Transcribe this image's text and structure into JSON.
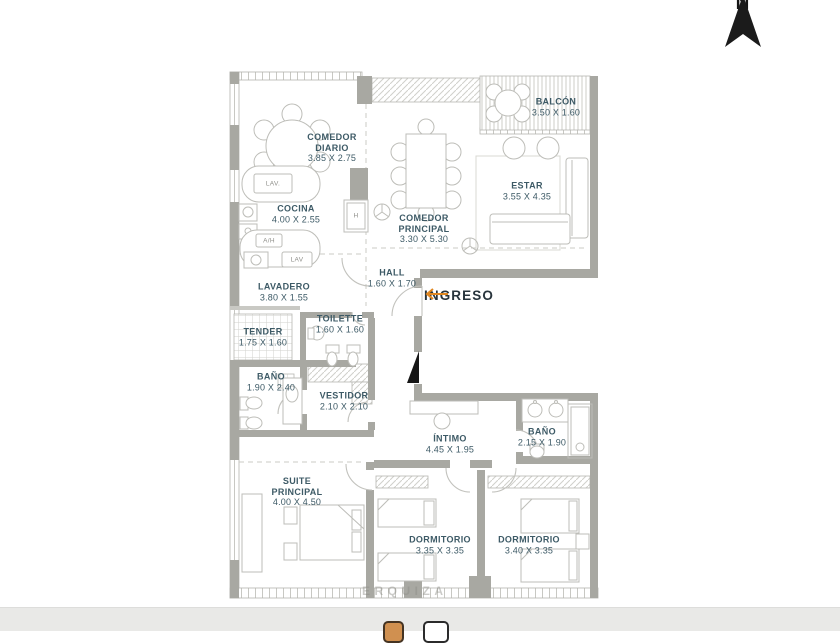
{
  "page": {
    "background": "#ffffff",
    "footer_band_color": "#e9e9e7"
  },
  "colors": {
    "wall": "#a8a8a2",
    "line": "#bdbdb8",
    "label": "#3d5a66",
    "entry_arrow": "#e0861f",
    "entry_text": "#28343c"
  },
  "compass": {
    "label": "N"
  },
  "entry": {
    "label": "INGRESO"
  },
  "watermark": {
    "text": "ERQUIZA"
  },
  "rooms": [
    {
      "id": "comedor-diario",
      "name": "COMEDOR DIARIO",
      "dims": "3.85 X 2.75"
    },
    {
      "id": "cocina",
      "name": "COCINA",
      "dims": "4.00 X 2.55"
    },
    {
      "id": "lavadero",
      "name": "LAVADERO",
      "dims": "3.80 X 1.55"
    },
    {
      "id": "tender",
      "name": "TENDER",
      "dims": "1.75 X 1.60"
    },
    {
      "id": "comedor-principal",
      "name": "COMEDOR PRINCIPAL",
      "dims": "3.30 X 5.30"
    },
    {
      "id": "estar",
      "name": "ESTAR",
      "dims": "3.55 X 4.35"
    },
    {
      "id": "balcon",
      "name": "BALCÓN",
      "dims": "3.50 X 1.60"
    },
    {
      "id": "hall",
      "name": "HALL",
      "dims": "1.60 X 1.70"
    },
    {
      "id": "toilette",
      "name": "TOILETTE",
      "dims": "1.60 X 1.60"
    },
    {
      "id": "bano-principal",
      "name": "BAÑO",
      "dims": "1.90 X 2.40"
    },
    {
      "id": "vestidor",
      "name": "VESTIDOR",
      "dims": "2.10 X 2.10"
    },
    {
      "id": "intimo",
      "name": "ÍNTIMO",
      "dims": "4.45 X 1.95"
    },
    {
      "id": "bano-2",
      "name": "BAÑO",
      "dims": "2.15 X 1.90"
    },
    {
      "id": "suite-principal",
      "name": "SUITE PRINCIPAL",
      "dims": "4.00 X 4.50"
    },
    {
      "id": "dormitorio-1",
      "name": "DORMITORIO",
      "dims": "3.35 X 3.35"
    },
    {
      "id": "dormitorio-2",
      "name": "DORMITORIO",
      "dims": "3.40 X 3.35"
    }
  ],
  "fixtures": {
    "kitchen_sink": "LAV.",
    "water_heater": "A/H",
    "laundry_sink": "LAV",
    "oven": "H"
  }
}
